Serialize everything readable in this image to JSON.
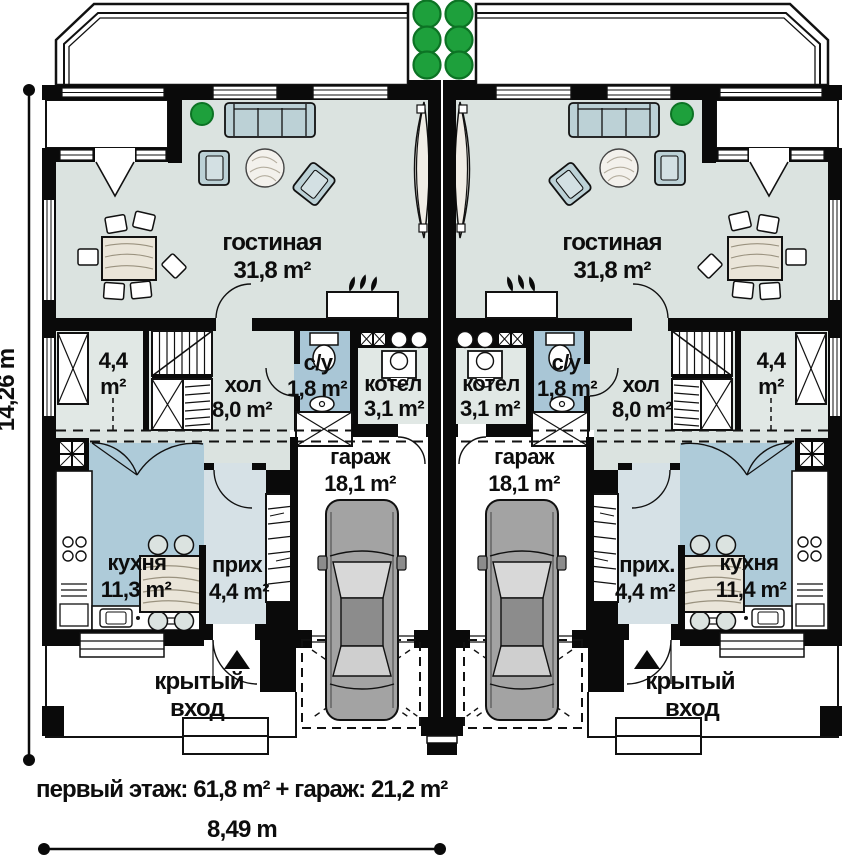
{
  "plan": {
    "summary": "первый этаж: 61,8 m² + гараж: 21,2 m²",
    "dimensions": {
      "height": "14,26 m",
      "width": "8,49 m"
    },
    "colors": {
      "wall": "#0a0a0a",
      "room_light": "#dbe3e0",
      "room_blue": "#aecbd9",
      "entry_blue": "#d6e1e6",
      "tree_green": "#1ea03c"
    },
    "units": {
      "left": {
        "living_name": "гостиная",
        "living_area": "31,8 m²",
        "closet_value": "4,4",
        "closet_unit": "m²",
        "hall_name": "хол",
        "hall_area": "8,0 m²",
        "wc_name": "с/у",
        "wc_area": "1,8 m²",
        "boiler_name": "котел",
        "boiler_area": "3,1 m²",
        "garage_name": "гараж",
        "garage_area": "18,1 m²",
        "kitchen_name": "кухня",
        "kitchen_area": "11,3 m²",
        "entry_name": "прих",
        "entry_area": "4,4 m²",
        "porch_line1": "крытый",
        "porch_line2": "вход"
      },
      "right": {
        "living_name": "гостиная",
        "living_area": "31,8 m²",
        "closet_value": "4,4",
        "closet_unit": "m²",
        "hall_name": "хол",
        "hall_area": "8,0 m²",
        "wc_name": "с/у",
        "wc_area": "1,8 m²",
        "boiler_name": "котел",
        "boiler_area": "3,1 m²",
        "garage_name": "гараж",
        "garage_area": "18,1 m²",
        "kitchen_name": "кухня",
        "kitchen_area": "11,4 m²",
        "entry_name": "прих.",
        "entry_area": "4,4 m²",
        "porch_line1": "крытый",
        "porch_line2": "вход"
      }
    }
  }
}
